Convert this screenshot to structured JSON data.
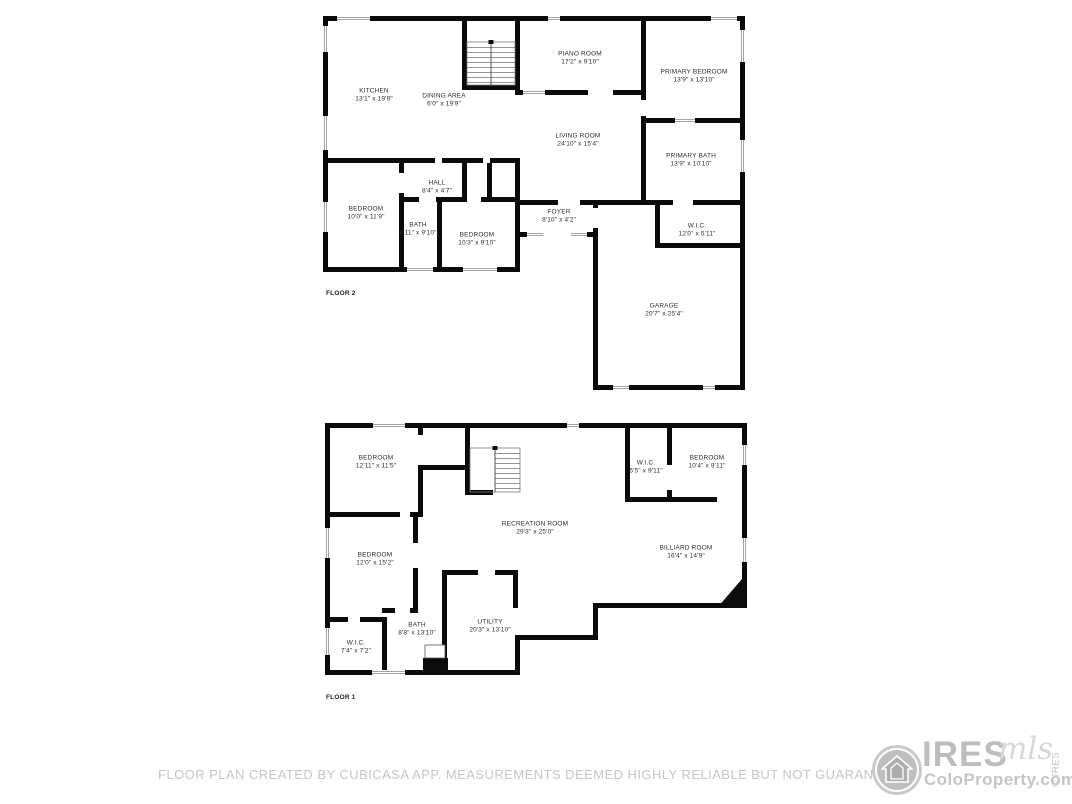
{
  "page": {
    "background": "#ffffff"
  },
  "floors": [
    {
      "label": "FLOOR 2",
      "rooms": [
        {
          "name": "KITCHEN",
          "dims": "13'1\" x 19'9\""
        },
        {
          "name": "DINING AREA",
          "dims": "6'0\" x 19'9\""
        },
        {
          "name": "PIANO ROOM",
          "dims": "17'2\" x 9'10\""
        },
        {
          "name": "PRIMARY BEDROOM",
          "dims": "13'9\" x 13'10\""
        },
        {
          "name": "LIVING ROOM",
          "dims": "24'10\" x 15'4\""
        },
        {
          "name": "PRIMARY BATH",
          "dims": "13'9\" x 10'10\""
        },
        {
          "name": "HALL",
          "dims": "8'4\" x 4'7\""
        },
        {
          "name": "BEDROOM",
          "dims": "10'0\" x 11'9\""
        },
        {
          "name": "BATH",
          "dims": "4'11\" x 9'10\""
        },
        {
          "name": "BEDROOM",
          "dims": "10'3\" x 9'10\""
        },
        {
          "name": "FOYER",
          "dims": "8'10\" x 4'2\""
        },
        {
          "name": "W.I.C.",
          "dims": "12'0\" x 5'11\""
        },
        {
          "name": "GARAGE",
          "dims": "20'7\" x 25'4\""
        }
      ]
    },
    {
      "label": "FLOOR 1",
      "rooms": [
        {
          "name": "BEDROOM",
          "dims": "12'11\" x 11'5\""
        },
        {
          "name": "W.I.C.",
          "dims": "5'5\" x 9'11\""
        },
        {
          "name": "BEDROOM",
          "dims": "10'4\" x 9'11\""
        },
        {
          "name": "RECREATION ROOM",
          "dims": "29'3\" x 25'0\""
        },
        {
          "name": "BEDROOM",
          "dims": "12'0\" x 15'2\""
        },
        {
          "name": "BILLIARD ROOM",
          "dims": "16'4\" x 14'9\""
        },
        {
          "name": "W.I.C.",
          "dims": "7'4\" x 7'2\""
        },
        {
          "name": "BATH",
          "dims": "8'8\" x 13'10\""
        },
        {
          "name": "UTILITY",
          "dims": "20'3\" x 13'10\""
        }
      ]
    }
  ],
  "footer": {
    "disclaimer": "FLOOR PLAN CREATED BY CUBICASA APP. MEASUREMENTS DEEMED HIGHLY RELIABLE BUT NOT GUARANTEED."
  },
  "logo": {
    "brand": "IRES",
    "script": "mls",
    "site": "ColoProperty.com",
    "copyright": "© IRES",
    "icon": "house-icon"
  },
  "colors": {
    "wall": "#0b0b0b",
    "room_text": "#2e2e2e",
    "muted_text": "#c6c6c6",
    "logo_gray": "#bdbdbd"
  }
}
